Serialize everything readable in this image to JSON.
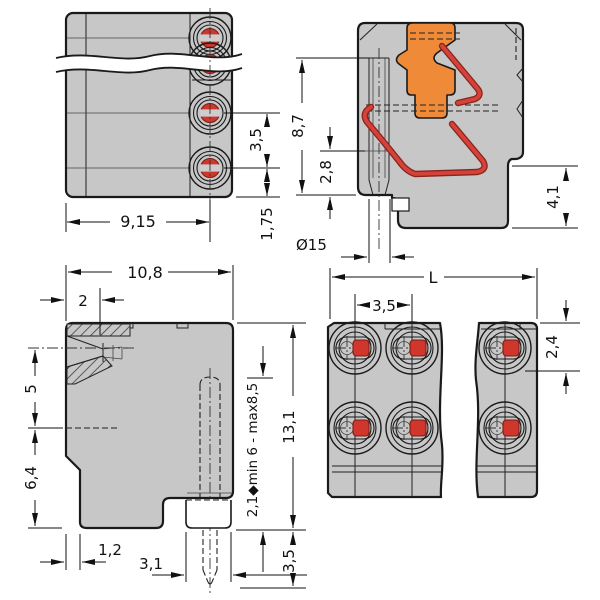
{
  "drawing_type": "technical dimension drawing, 4 views of push-wire PCB terminal block",
  "colors": {
    "body": "#c7c7c7",
    "opening": "#d2d2d2",
    "band": "#cdcdcd",
    "orange": "#ef8a38",
    "spring": "#d4423a",
    "contact": "#cf362c",
    "outline": "#1a1a1a"
  },
  "dims": {
    "tl": {
      "width": "9,15",
      "pitch": "3,5",
      "edge": "1,75"
    },
    "tr": {
      "height": "8,7",
      "lower": "2,8",
      "hole": "Ø15",
      "foot": "4,1"
    },
    "bl": {
      "width": "10,8",
      "entry": "2",
      "upper": "5",
      "lower": "6,4",
      "step": "1,2",
      "base": "3,1",
      "height": "13,1",
      "pin": "2,1◆min 6 - max8,5",
      "pin_len": "3,5"
    },
    "br": {
      "length": "L",
      "pitch": "3,5",
      "offset": "2,4"
    }
  }
}
